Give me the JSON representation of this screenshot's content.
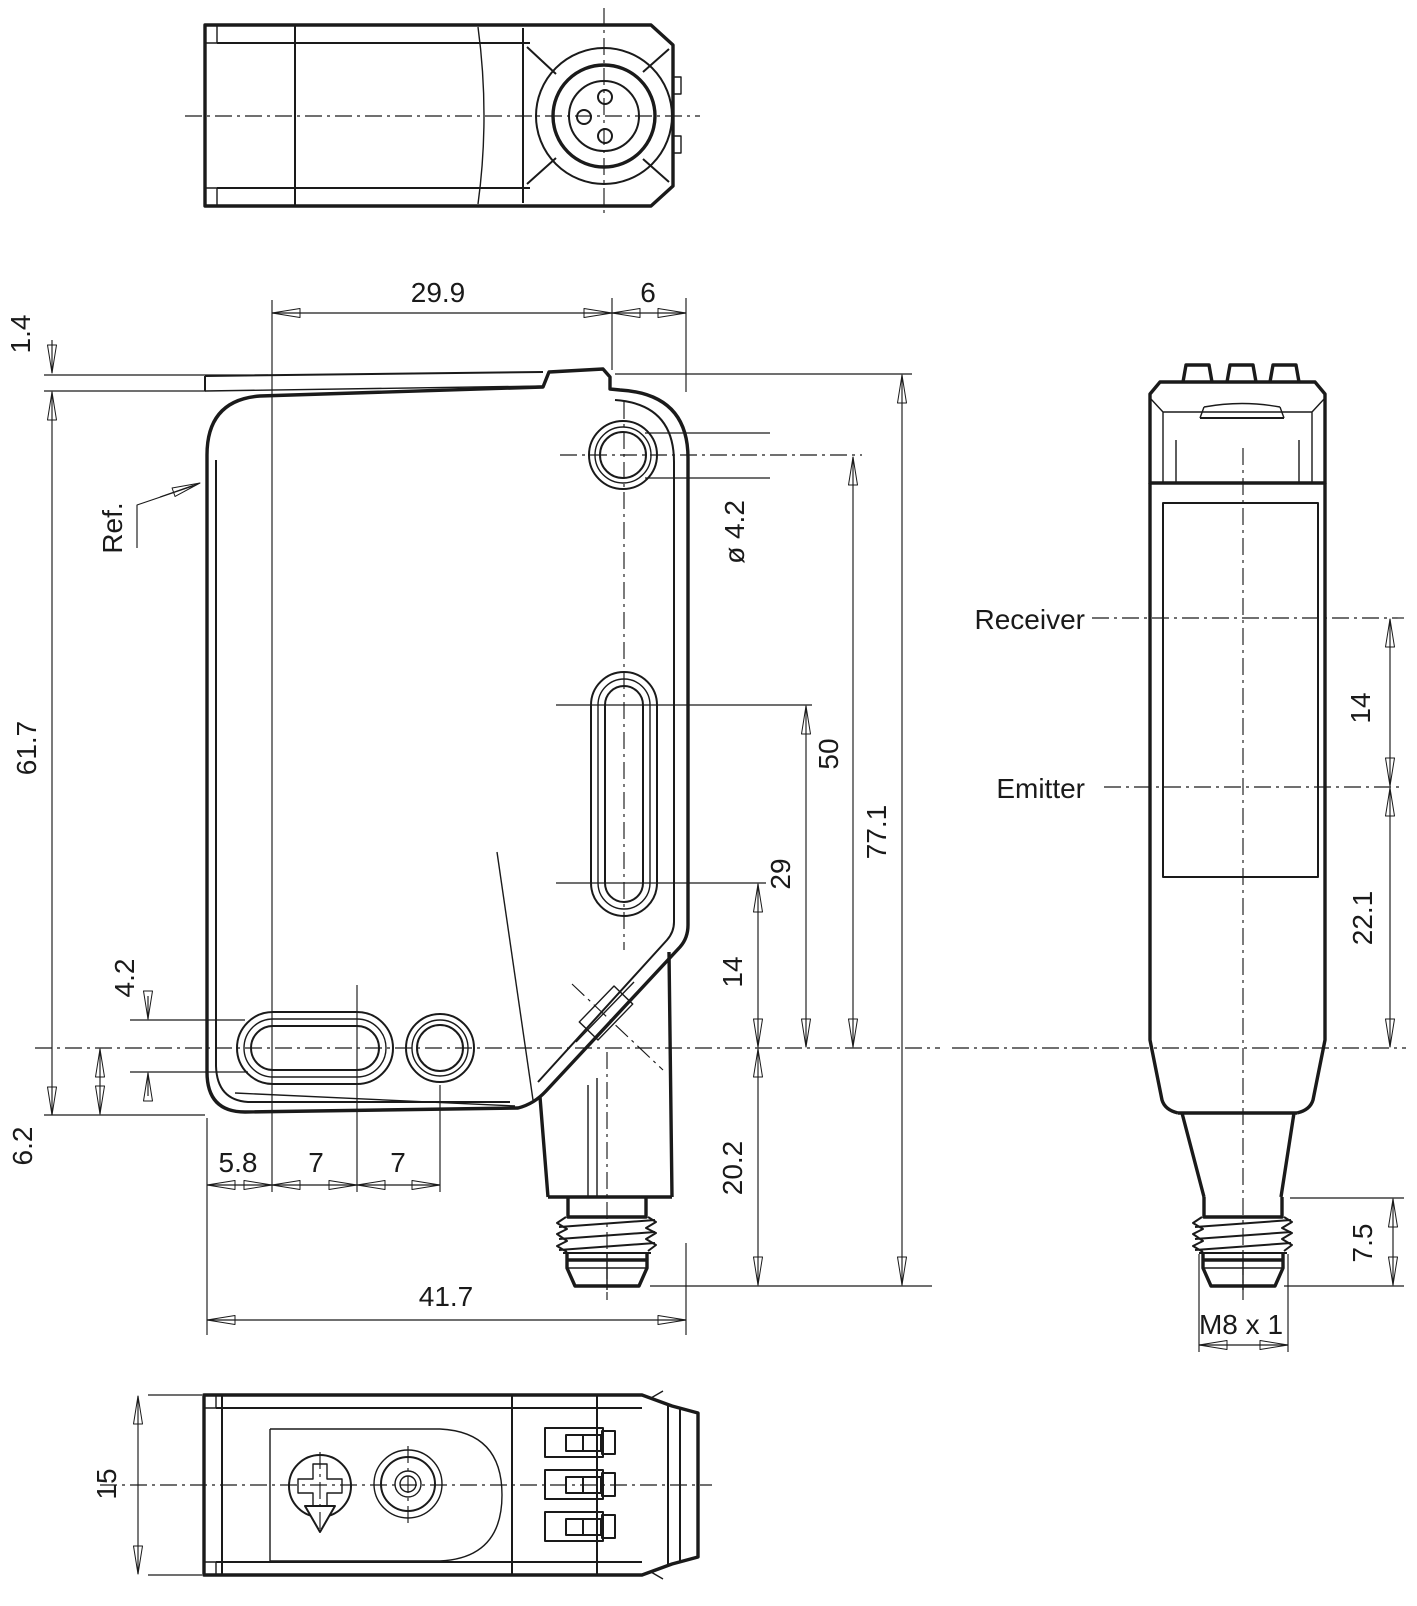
{
  "colors": {
    "line": "#1a1a1a",
    "background": "#ffffff"
  },
  "labels": {
    "top_width": "29.9",
    "top_offset": "6",
    "plate_thickness": "1.4",
    "ref_label": "Ref.",
    "body_height": "61.7",
    "hole_dia": "ø 4.2",
    "hole_to_center": "50",
    "slot_top_to_center": "29",
    "slot_bottom_to_center": "14",
    "total_height": "77.1",
    "center_to_tip": "20.2",
    "slot_width": "4.2",
    "center_to_bottom": "6.2",
    "foot_offset": "5.8",
    "pitch_a": "7",
    "pitch_b": "7",
    "body_width": "41.7",
    "receiver": "Receiver",
    "emitter": "Emitter",
    "beam_gap": "14",
    "emitter_to_center": "22.1",
    "connector_length": "7.5",
    "thread": "M8 x 1",
    "housing_depth": "15"
  }
}
